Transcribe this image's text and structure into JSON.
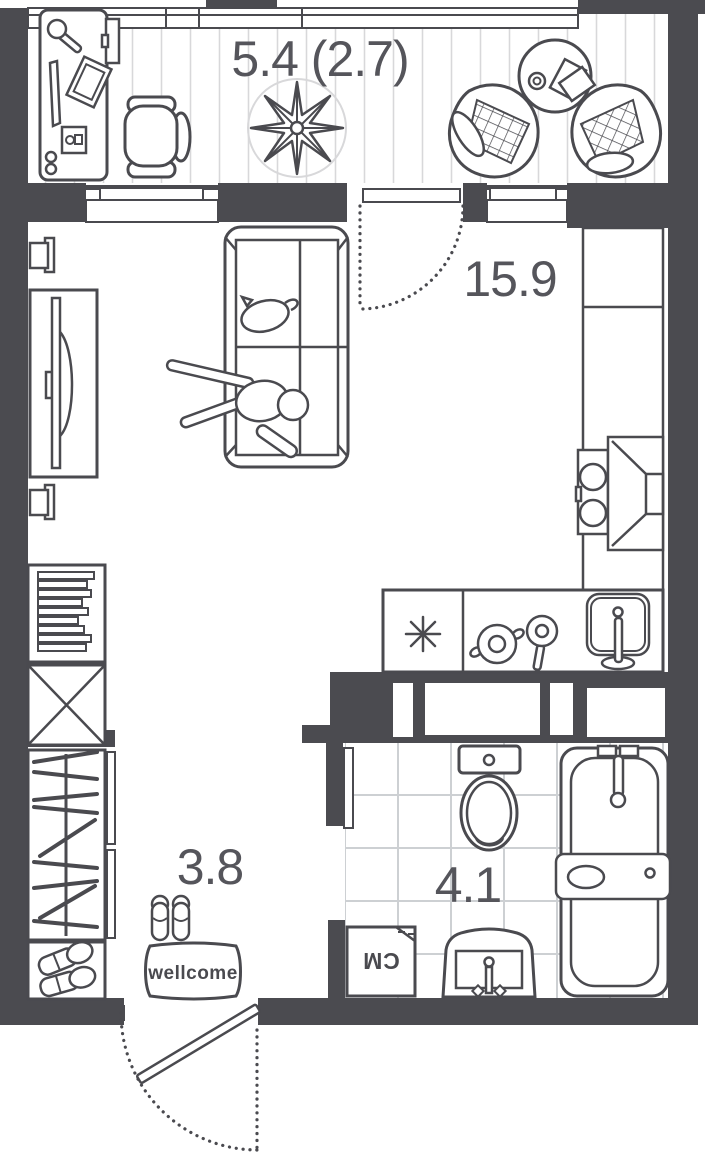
{
  "rooms": {
    "balcony": {
      "area_label": "5.4 (2.7)"
    },
    "living": {
      "area_label": "15.9"
    },
    "hallway": {
      "area_label": "3.8"
    },
    "bathroom": {
      "area_label": "4.1"
    }
  },
  "labels": {
    "doormat": "wellcome",
    "washer": "СМ",
    "kitchen_appliance_symbol": "✳"
  },
  "colors": {
    "wall": "#4b4b50",
    "ink": "#4a4a4f",
    "floor_hatch": "#d8d8da",
    "tile": "#cdd0d3",
    "text": "#55555b"
  }
}
